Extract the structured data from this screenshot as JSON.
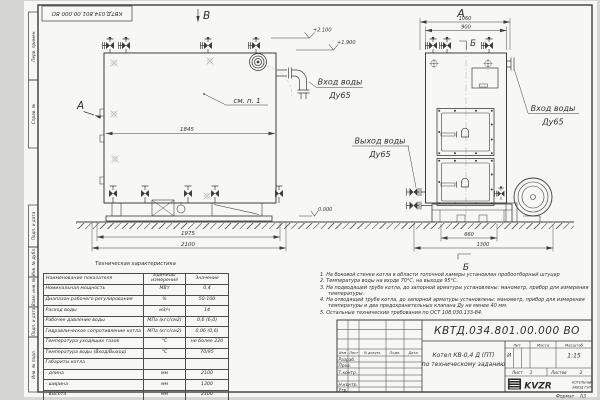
{
  "colors": {
    "paper": "#f7f7f4",
    "line": "#3d3d3d",
    "hatch": "#6f6f6f",
    "light_line": "#b9b9b9"
  },
  "frame": {
    "stamp_number": "КВТД.034.801.00.000  ВО",
    "left_labels": [
      "Перв. примен.",
      "Справ. №",
      "Подп. и дата",
      "Инв. № дубл.",
      "Взам. инв. №",
      "Подп. и дата",
      "Инв. № подл."
    ]
  },
  "views": {
    "side": {
      "view_arrow_top": "В",
      "view_arrow_left": "А",
      "callout": "см. п. 1",
      "dim_width_inner": "1845",
      "dim_width": "1975",
      "dim_width_total": "2100",
      "elev_top": "+2.100",
      "elev_mid": "+1.900",
      "elev_ground": "0.000",
      "water_inlet_line1": "Вход воды",
      "water_inlet_line2": "Ду65"
    },
    "front": {
      "view_label": "А",
      "section_mark": "Б",
      "dim_top_total": "1060",
      "dim_top": "900",
      "dim_base": "660",
      "dim_base_total": "1300",
      "water_inlet_line1": "Вход воды",
      "water_inlet_line2": "Ду65",
      "water_outlet_line1": "Выход воды",
      "water_outlet_line2": "Ду65"
    }
  },
  "spec_table": {
    "title": "Техническая характеристика",
    "headers": [
      "Наименование показателя",
      "Единицы измерения",
      "Значение"
    ],
    "rows": [
      {
        "name": "Номинальная мощность",
        "unit": "МВт",
        "value": "0,4"
      },
      {
        "name": "Диапазон рабочего регулирования",
        "unit": "%",
        "value": "50-100"
      },
      {
        "name": "Расход воды",
        "unit": "м3/ч",
        "value": "14"
      },
      {
        "name": "Рабочее давление воды",
        "unit": "МПа (кгс/см2)",
        "value": "0,6 (6,0)"
      },
      {
        "name": "Гидравлическое сопротивление котла",
        "unit": "МПа (кгс/см2)",
        "value": "0,06 (0,6)"
      },
      {
        "name": "Температура уходящих газов",
        "unit": "°С",
        "value": "не более 220"
      },
      {
        "name": "Температура воды (Вход/Выход)",
        "unit": "°С",
        "value": "70/95"
      },
      {
        "name": "Габариты котла",
        "unit": "",
        "value": ""
      },
      {
        "name": "- длина",
        "unit": "мм",
        "value": "2100"
      },
      {
        "name": "- ширина",
        "unit": "мм",
        "value": "1300"
      },
      {
        "name": "- высота",
        "unit": "мм",
        "value": "2100"
      }
    ]
  },
  "notes": [
    "1.  На боковой стенке котла в области топочной камеры установлен пробоотборный штуцер",
    "2.  Температура воды на входе 70°С, на выходе 95°С.",
    "3.  На подводящей трубе котла, до запорной арматуры установлены: манометр, прибор для измерения температуры.",
    "4.  На отводящей трубе котла, до запорной арматуры установлены: манометр, прибор для измерения температуры и два предохранительных клапана Ду не менее 40 мм.",
    "5.  Остальные технические требования по ОСТ 108.030.133-84."
  ],
  "title_block": {
    "doc_number": "КВТД.034.801.00.000  ВО",
    "product_line1": "Котел  КВ-0,4  Д  (ПТ)",
    "product_line2": "по техническому заданию",
    "rev_headers": [
      "Изм",
      "Лист",
      "N докум.",
      "Подп.",
      "Дата"
    ],
    "sign_rows": [
      "Разраб.",
      "Пров.",
      "Т.контр.",
      "Н.контр.",
      "Утв."
    ],
    "lit_label": "Лит.",
    "lit_value": "И",
    "mass_label": "Масса",
    "scale_label": "Масштаб",
    "scale_value": "1:15",
    "sheet_label": "Лист",
    "sheet_value": "1",
    "sheets_label": "Листов",
    "sheets_value": "2",
    "company_logo": "KVZR",
    "company_line1": "КОТЕЛЬНЫЙ",
    "company_line2": "ЗАВОД РЭП",
    "format_label": "Формат",
    "format_value": "А3"
  }
}
